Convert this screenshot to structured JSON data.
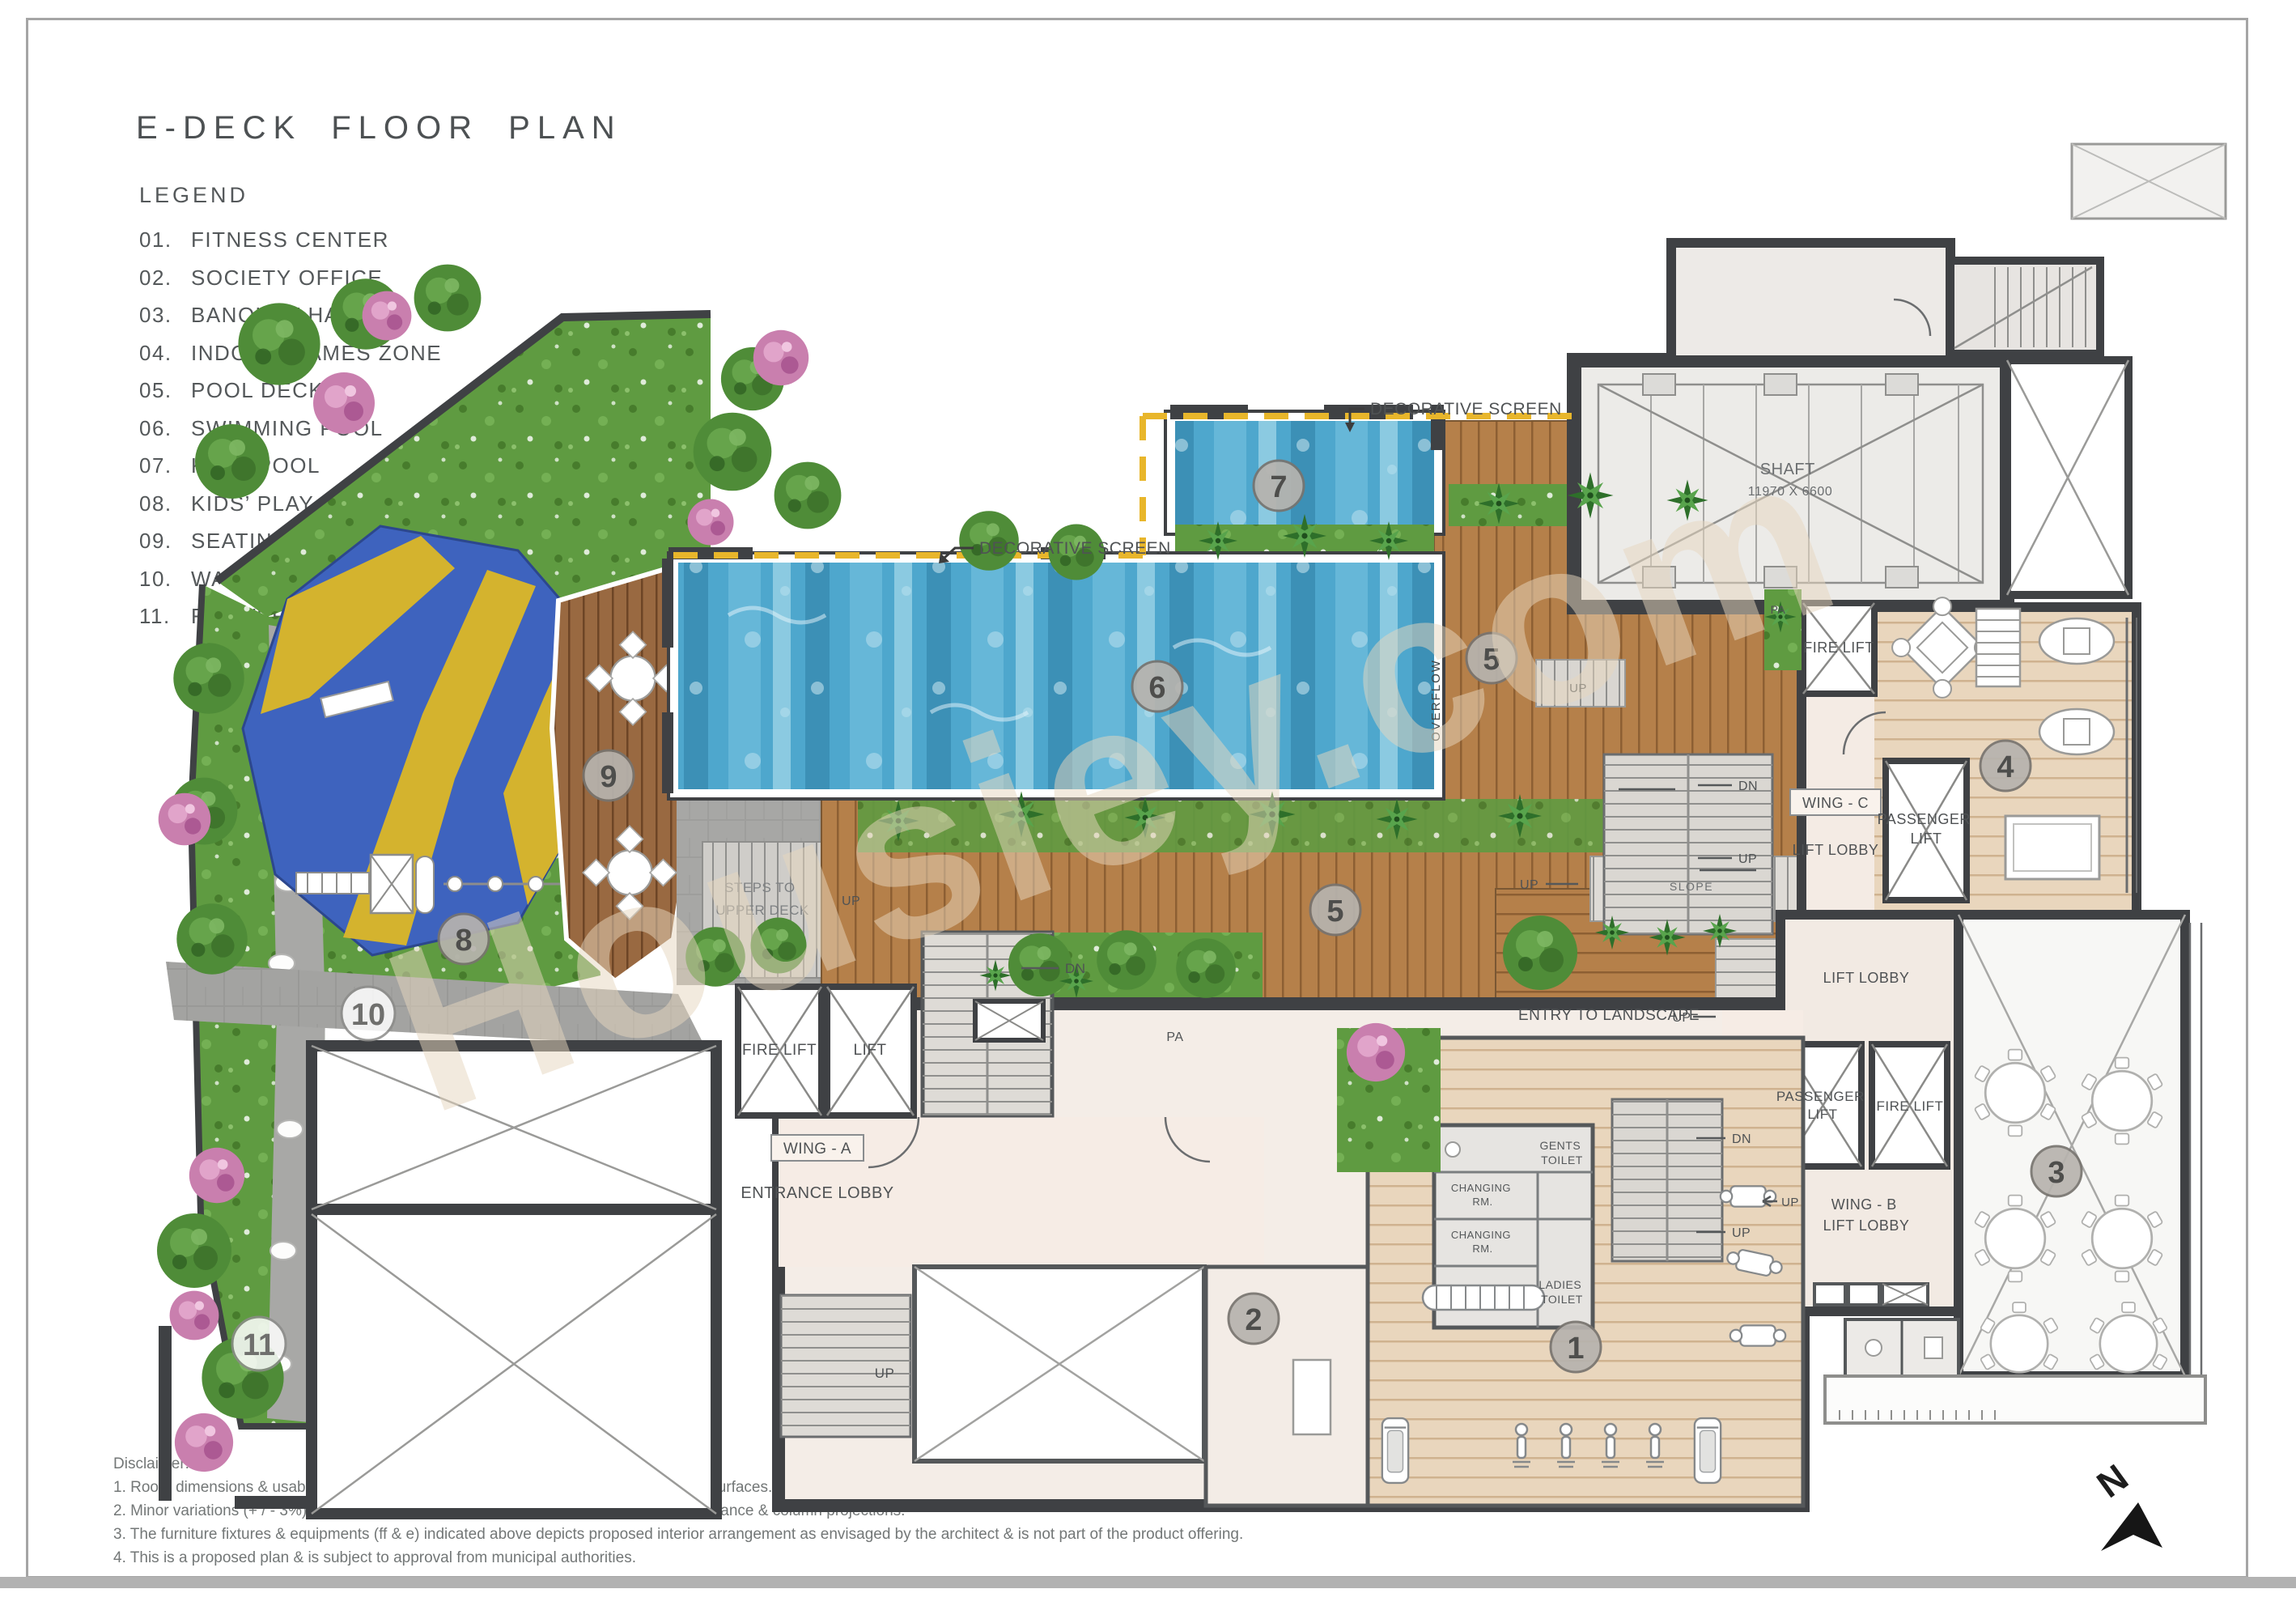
{
  "page": {
    "title": "E-DECK FLOOR PLAN",
    "watermark": "Housiey.com",
    "north_label": "N"
  },
  "legend": {
    "heading": "LEGEND",
    "items": [
      {
        "num": "01.",
        "label": "FITNESS CENTER"
      },
      {
        "num": "02.",
        "label": "SOCIETY OFFICE"
      },
      {
        "num": "03.",
        "label": "BANQUET HALL"
      },
      {
        "num": "04.",
        "label": "INDOOR GAMES ZONE"
      },
      {
        "num": "05.",
        "label": "POOL DECK"
      },
      {
        "num": "06.",
        "label": "SWIMMING POOL"
      },
      {
        "num": "07.",
        "label": "KIDS’ POOL"
      },
      {
        "num": "08.",
        "label": "KIDS’ PLAY AREA"
      },
      {
        "num": "09.",
        "label": "SEATING DECK"
      },
      {
        "num": "10.",
        "label": "WALKING PATH"
      },
      {
        "num": "11.",
        "label": "FLOWER PATIO"
      }
    ]
  },
  "disclaimer": {
    "heading": "Disclaimer:",
    "lines": [
      "1. Room dimensions & usable area indicated are measured considering unfinished wall surfaces.",
      "2. Minor variations (+ / - 3%) in actual carpet areas may occur as a result of finishing tolerance & column projections.",
      "3. The furniture fixtures & equipments (ff & e) indicated above depicts proposed interior arrangement as envisaged by the architect & is not part of the product offering.",
      "4. This is a proposed plan & is subject to approval from municipal authorities."
    ]
  },
  "plan": {
    "labels": {
      "decorative_screen": "DECORATIVE SCREEN",
      "shaft": "SHAFT",
      "shaft_dim": "11970 X 6600",
      "overflow": "OVERFLOW",
      "entry_to_landscape": "ENTRY TO LANDSCAPE",
      "steps_to": "STEPS TO",
      "upper_deck": "UPPER DECK",
      "slope": "SLOPE",
      "fire_lift": "FIRE LIFT",
      "lift": "LIFT",
      "lift_lobby": "LIFT LOBBY",
      "passenger": "PASSENGER",
      "wing_a": "WING - A",
      "wing_b": "WING - B",
      "wing_c": "WING - C",
      "entrance_lobby": "ENTRANCE LOBBY",
      "gents": "GENTS",
      "ladies": "LADIES",
      "toilet": "TOILET",
      "changing": "CHANGING",
      "rm": "RM.",
      "up": "UP",
      "dn": "DN",
      "pa": "PA"
    },
    "markers": {
      "m1": "1",
      "m2": "2",
      "m3": "3",
      "m4": "4",
      "m5": "5",
      "m6": "6",
      "m7": "7",
      "m8": "8",
      "m9": "9",
      "m10": "10",
      "m11": "11"
    }
  }
}
